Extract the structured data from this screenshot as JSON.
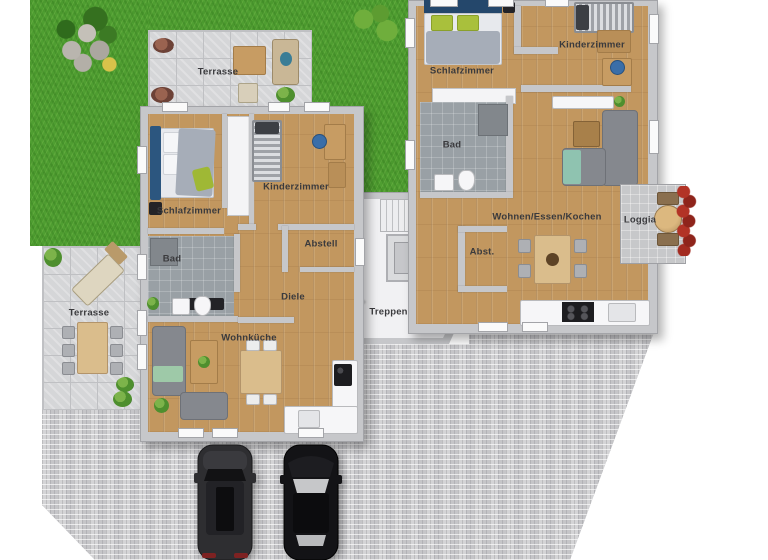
{
  "plan_title": "Grundriss / floor plan with two apartments, stairwell, garden and parking",
  "rooms": {
    "left": {
      "schlafzimmer": "Schlafzimmer",
      "kinderzimmer": "Kinderzimmer",
      "bad": "Bad",
      "abstell": "Abstell",
      "diele": "Diele",
      "wohnkueche": "Wohnküche"
    },
    "right": {
      "schlafzimmer": "Schlafzimmer",
      "kinderzimmer": "Kinderzimmer",
      "bad": "Bad",
      "wohnen": "Wohnen/Essen/Kochen",
      "abst": "Abst.",
      "loggia": "Loggia"
    },
    "outdoor": {
      "terrasse_top": "Terrasse",
      "terrasse_bottom": "Terrasse"
    },
    "shared": {
      "treppenhaus": "Treppenhaus"
    }
  },
  "colors": {
    "grass": "#4f9e31",
    "wood_floor": "#c2975f",
    "wall_gray": "#c6c7ca",
    "bathroom_tile": "#99a0a5",
    "terrace_tile": "#d5d6d8",
    "pavement": "#cccccf",
    "bed_blue": "#2c567f",
    "pillow_green": "#a9c03c",
    "sofa_gray": "#85888e",
    "table_wood": "#dabd8c",
    "loggia_flowers": "#a32b20",
    "car_dark": "#2e2e31",
    "car_black": "#131316"
  }
}
